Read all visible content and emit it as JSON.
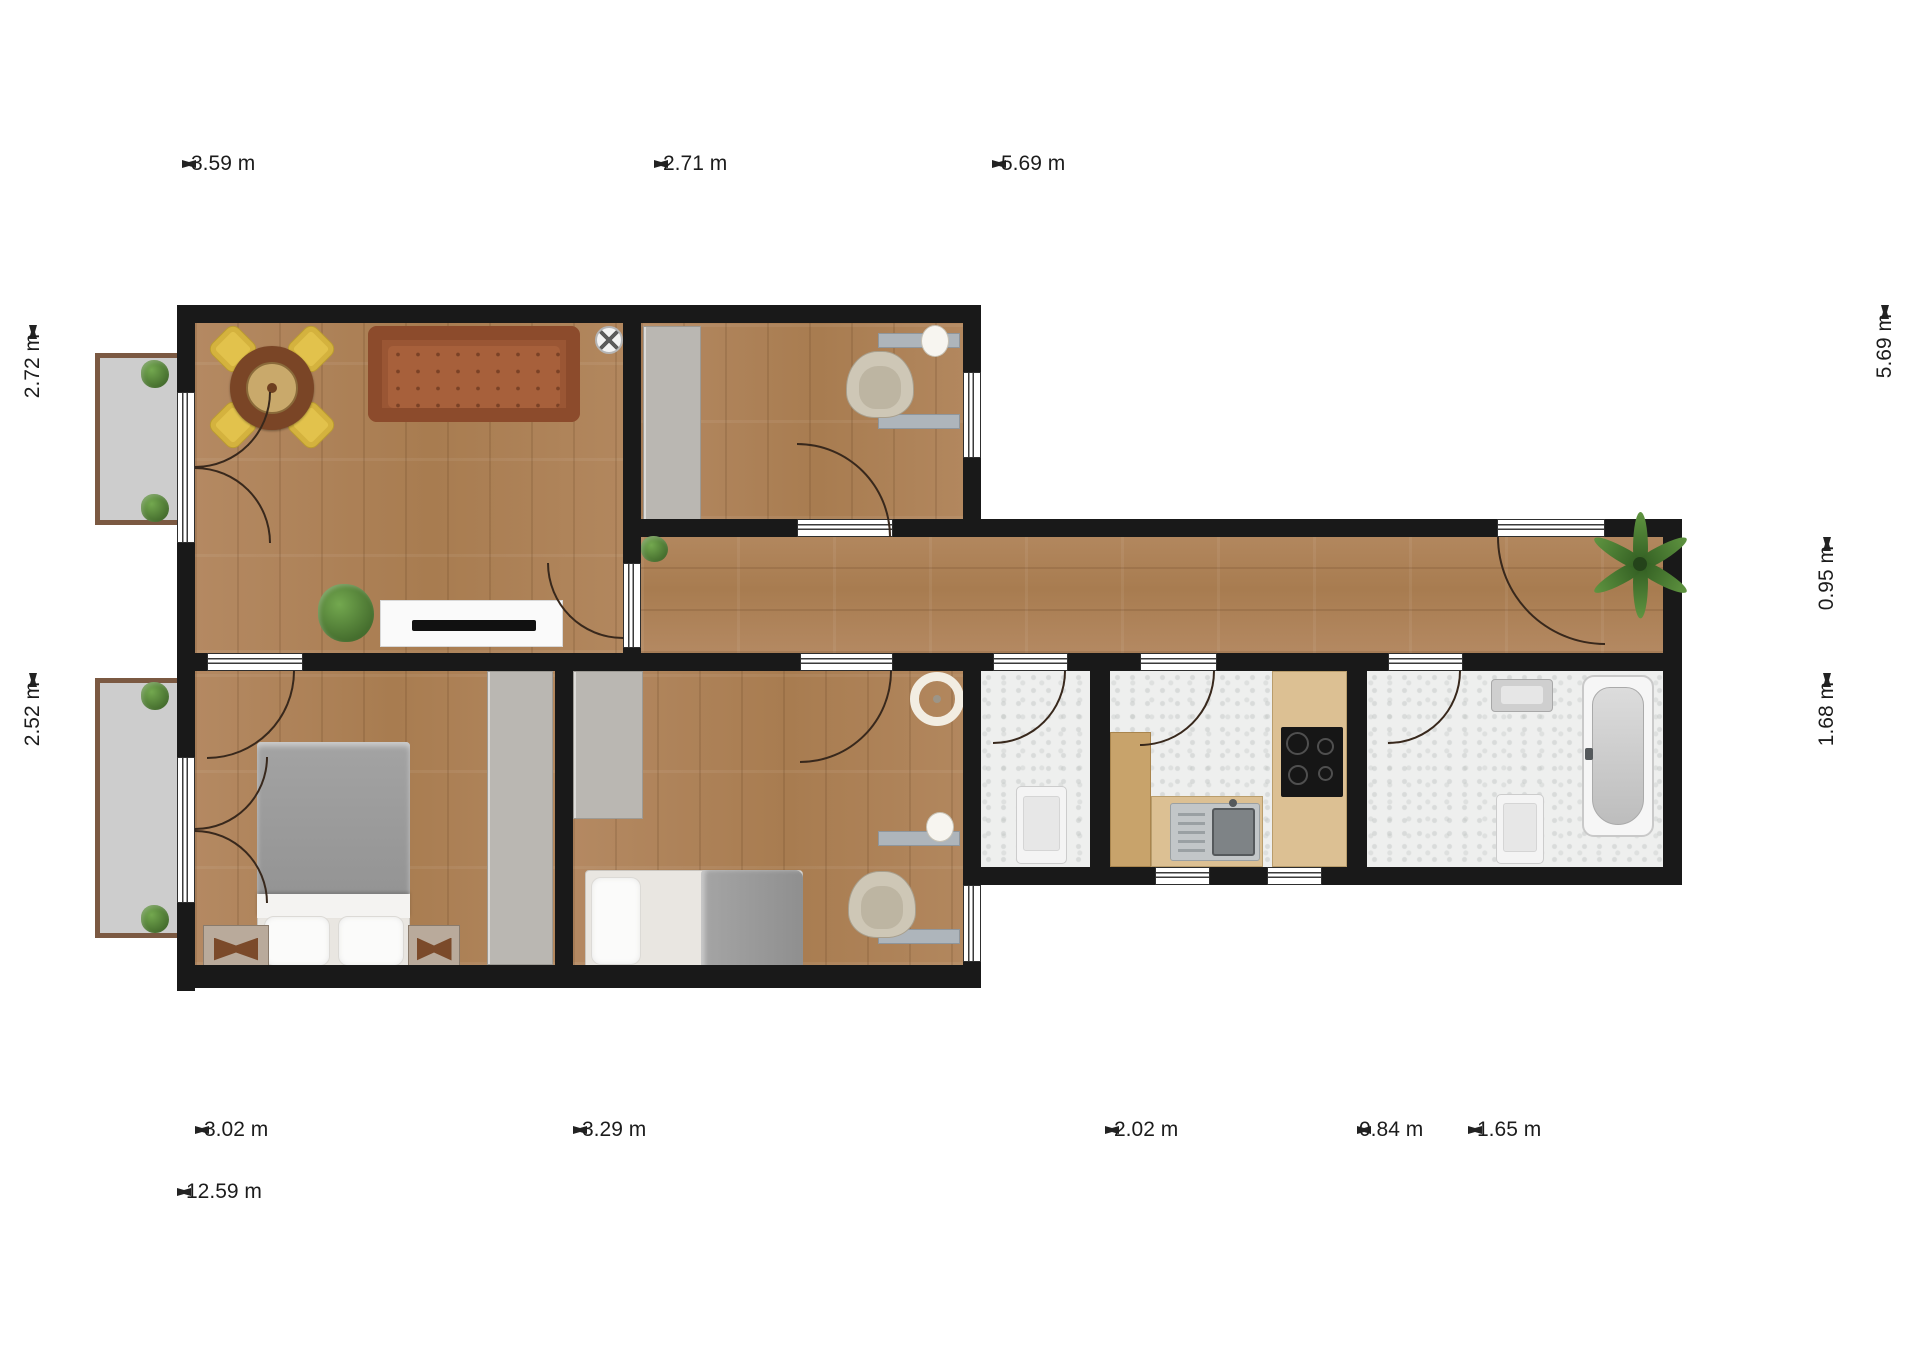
{
  "palette": {
    "wall": "#191919",
    "wood_floor": "#b08258",
    "tile_floor": "#eeefee",
    "balcony_floor": "#cdcdcd",
    "balcony_frame": "#7b5942",
    "sofa": "#9a5634",
    "chair_yellow": "#e2c24c",
    "dimension_text": "#1c1c1c"
  },
  "dims": {
    "top": [
      {
        "label": "3.59 m"
      },
      {
        "label": "2.71 m"
      },
      {
        "label": "5.69 m"
      }
    ],
    "left": [
      {
        "label": "2.72 m"
      },
      {
        "label": "2.52 m"
      }
    ],
    "right": [
      {
        "label": "0.95 m"
      },
      {
        "label": "1.68 m"
      },
      {
        "label": "5.69 m"
      }
    ],
    "bottom": [
      {
        "label": "3.02 m"
      },
      {
        "label": "3.29 m"
      },
      {
        "label": "2.02 m"
      },
      {
        "label": "0.84 m"
      },
      {
        "label": "1.65 m"
      }
    ],
    "total": {
      "label": "12.59 m"
    }
  }
}
